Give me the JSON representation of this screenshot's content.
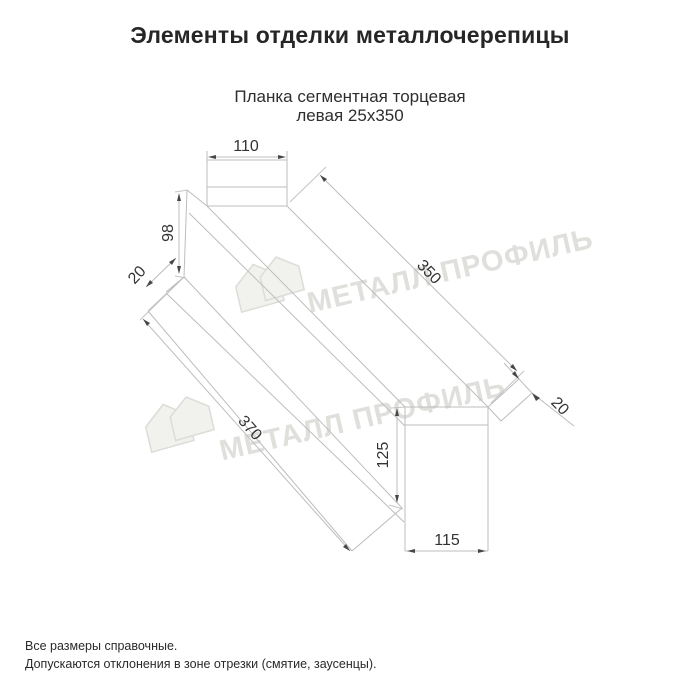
{
  "page": {
    "title": "Элементы отделки металлочерепицы"
  },
  "product": {
    "title_line1": "Планка сегментная торцевая",
    "title_line2": "левая 25х350"
  },
  "dimensions": {
    "top_face_width": "110",
    "left_face_height": "98",
    "left_hem_width": "20",
    "top_edge_length": "350",
    "bottom_edge_length": "370",
    "right_hem_width": "20",
    "right_face_height": "125",
    "right_face_width": "115"
  },
  "watermark": {
    "text": "МЕТАЛЛ ПРОФИЛЬ"
  },
  "footer": {
    "note1": "Все размеры справочные.",
    "note2": "Допускаются отклонения в зоне отрезки (смятие, заусенцы)."
  },
  "colors": {
    "line": "#bdbdbd",
    "dimension_text": "#333333",
    "watermark": "#dfdfdb",
    "title": "#262626"
  }
}
